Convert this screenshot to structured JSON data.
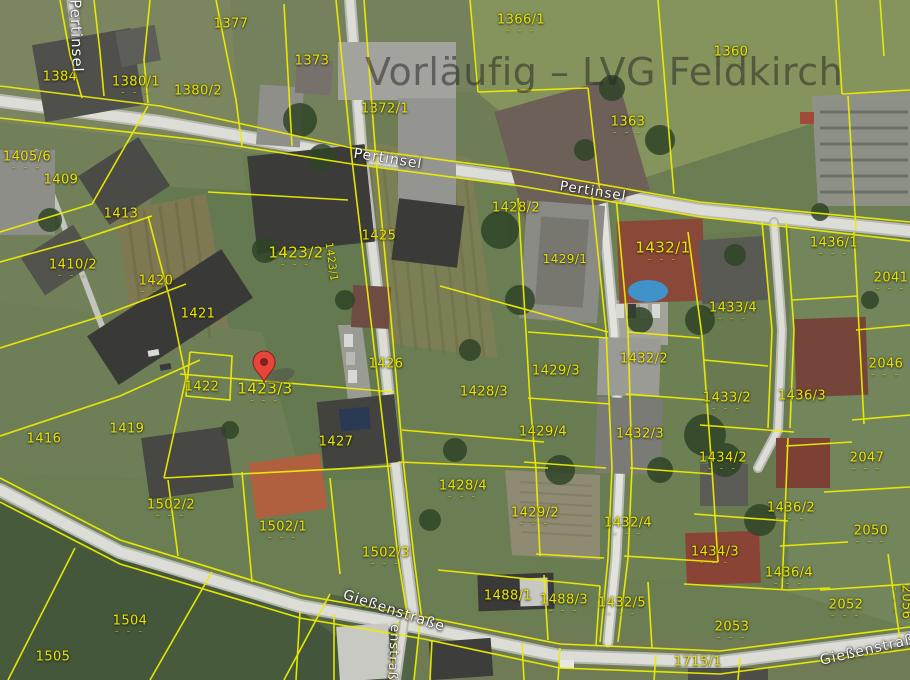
{
  "map": {
    "watermark": {
      "text": "Vorläufig – LVG Feldkirch",
      "x": 365,
      "y": 50,
      "font_size": 38
    },
    "marker": {
      "x": 264,
      "y": 382,
      "color": "#e8443a",
      "color_dark": "#7c231c",
      "label": "dropped-pin"
    },
    "colors": {
      "parcel_line": "#eded00",
      "parcel_label": "#e9e400",
      "street_label": "#fbfbf8",
      "watermark": "rgba(40,40,40,0.55)"
    },
    "tick_glyph": "– – –",
    "streets": [
      {
        "label": "Pertinsel",
        "x": 76,
        "y": 36,
        "rot": 88,
        "size": 15
      },
      {
        "label": "Pertinsel",
        "x": 388,
        "y": 159,
        "rot": 9,
        "size": 14
      },
      {
        "label": "Pertinsel",
        "x": 593,
        "y": 192,
        "rot": 9,
        "size": 13.5
      },
      {
        "label": "Gießenstraße",
        "x": 394,
        "y": 611,
        "rot": 18,
        "size": 14
      },
      {
        "label": "Gießenstraße",
        "x": 872,
        "y": 649,
        "rot": -13,
        "size": 14
      },
      {
        "label": "enstraße",
        "x": 393,
        "y": 657,
        "rot": 93,
        "size": 13
      }
    ],
    "parcels": [
      {
        "label": "1384",
        "x": 60,
        "y": 77
      },
      {
        "label": "1377",
        "x": 231,
        "y": 24
      },
      {
        "label": "1380/1",
        "x": 136,
        "y": 86,
        "ticks": true
      },
      {
        "label": "1380/2",
        "x": 198,
        "y": 91
      },
      {
        "label": "1373",
        "x": 312,
        "y": 61
      },
      {
        "label": "1372/1",
        "x": 385,
        "y": 109
      },
      {
        "label": "1366/1",
        "x": 521,
        "y": 24,
        "ticks": true
      },
      {
        "label": "1363",
        "x": 628,
        "y": 126,
        "ticks": true
      },
      {
        "label": "1360",
        "x": 731,
        "y": 56,
        "ticks": true
      },
      {
        "label": "1405/6",
        "x": 27,
        "y": 161,
        "ticks": true
      },
      {
        "label": "1409",
        "x": 61,
        "y": 180
      },
      {
        "label": "1413",
        "x": 121,
        "y": 214
      },
      {
        "label": "1410/2",
        "x": 73,
        "y": 269,
        "ticks": true
      },
      {
        "label": "1420",
        "x": 156,
        "y": 285,
        "ticks": true
      },
      {
        "label": "1421",
        "x": 198,
        "y": 314
      },
      {
        "label": "1422",
        "x": 202,
        "y": 387
      },
      {
        "label": "1423/2",
        "x": 296,
        "y": 257,
        "ticks": true,
        "size": 15
      },
      {
        "label": "1423/3",
        "x": 265,
        "y": 393,
        "ticks": true,
        "size": 15
      },
      {
        "label": "1423/1",
        "x": 331,
        "y": 262,
        "rot": 82,
        "size": 10.5
      },
      {
        "label": "1425",
        "x": 379,
        "y": 236
      },
      {
        "label": "1426",
        "x": 386,
        "y": 364
      },
      {
        "label": "1427",
        "x": 336,
        "y": 442
      },
      {
        "label": "1428/2",
        "x": 516,
        "y": 208
      },
      {
        "label": "1429/1",
        "x": 565,
        "y": 259,
        "size": 12
      },
      {
        "label": "1432/1",
        "x": 663,
        "y": 252,
        "ticks": true,
        "size": 15
      },
      {
        "label": "1436/1",
        "x": 834,
        "y": 247,
        "ticks": true
      },
      {
        "label": "2041",
        "x": 891,
        "y": 282,
        "ticks": true
      },
      {
        "label": "1433/4",
        "x": 733,
        "y": 312,
        "ticks": true
      },
      {
        "label": "1433/2",
        "x": 727,
        "y": 402,
        "ticks": true
      },
      {
        "label": "2046",
        "x": 886,
        "y": 368,
        "ticks": true
      },
      {
        "label": "1436/3",
        "x": 802,
        "y": 396
      },
      {
        "label": "1429/3",
        "x": 556,
        "y": 371
      },
      {
        "label": "1428/3",
        "x": 484,
        "y": 392
      },
      {
        "label": "1429/4",
        "x": 543,
        "y": 432
      },
      {
        "label": "1428/4",
        "x": 463,
        "y": 490,
        "ticks": true
      },
      {
        "label": "1429/2",
        "x": 535,
        "y": 517,
        "ticks": true
      },
      {
        "label": "1416",
        "x": 44,
        "y": 439
      },
      {
        "label": "1419",
        "x": 127,
        "y": 429
      },
      {
        "label": "1502/2",
        "x": 171,
        "y": 509,
        "ticks": true
      },
      {
        "label": "1502/1",
        "x": 283,
        "y": 531,
        "ticks": true
      },
      {
        "label": "1502/3",
        "x": 386,
        "y": 557,
        "ticks": true
      },
      {
        "label": "1432/2",
        "x": 644,
        "y": 359
      },
      {
        "label": "1432/3",
        "x": 640,
        "y": 434
      },
      {
        "label": "1434/2",
        "x": 723,
        "y": 462,
        "ticks": true
      },
      {
        "label": "2047",
        "x": 867,
        "y": 462,
        "ticks": true
      },
      {
        "label": "1436/2",
        "x": 791,
        "y": 512,
        "ticks": true
      },
      {
        "label": "2050",
        "x": 871,
        "y": 535,
        "ticks": true
      },
      {
        "label": "1432/4",
        "x": 628,
        "y": 527,
        "ticks": true
      },
      {
        "label": "1434/3",
        "x": 715,
        "y": 556,
        "ticks": true
      },
      {
        "label": "1436/4",
        "x": 789,
        "y": 577,
        "ticks": true
      },
      {
        "label": "1432/5",
        "x": 622,
        "y": 607,
        "ticks": true
      },
      {
        "label": "2052",
        "x": 846,
        "y": 609,
        "ticks": true
      },
      {
        "label": "2053",
        "x": 732,
        "y": 631,
        "ticks": true
      },
      {
        "label": "2056",
        "x": 902,
        "y": 602,
        "rot": 90,
        "ticks": true
      },
      {
        "label": "1488/1",
        "x": 508,
        "y": 596
      },
      {
        "label": "1488/3",
        "x": 564,
        "y": 604,
        "ticks": true
      },
      {
        "label": "1715/1",
        "x": 698,
        "y": 662
      },
      {
        "label": "1504",
        "x": 130,
        "y": 625,
        "ticks": true
      },
      {
        "label": "1505",
        "x": 53,
        "y": 657
      }
    ]
  }
}
